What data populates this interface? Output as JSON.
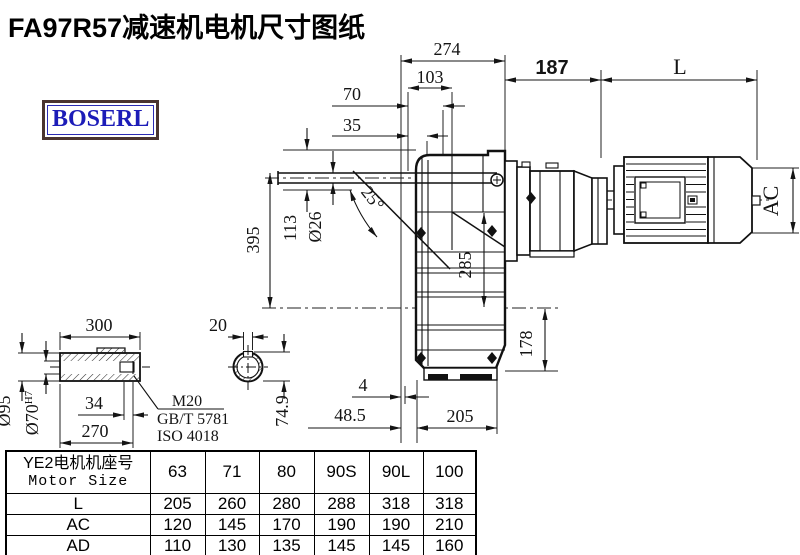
{
  "title": "FA97R57减速机电机尺寸图纸",
  "logo_text": "BOSERL",
  "dims": {
    "w274": "274",
    "w103": "103",
    "w70": "70",
    "w35": "35",
    "motor_gap": "187",
    "motor_len": "L",
    "motor_ac": "AC",
    "h395": "395",
    "h113": "113",
    "rod_dia": "Ø26",
    "angle": "25°",
    "h285": "285",
    "h178": "178",
    "off4": "4",
    "off485": "48.5",
    "w205": "205",
    "shaft_len": "300",
    "shaft_od": "Ø95",
    "bore": "Ø70",
    "bore_fit": "H7",
    "key34": "34",
    "w270": "270",
    "key20": "20",
    "h749": "74.9",
    "thread": "M20",
    "std_gb": "GB/T 5781",
    "std_iso": "ISO 4018"
  },
  "table": {
    "header_line1": "YE2电机机座号",
    "header_line2": "Motor Size",
    "sizes": [
      "63",
      "71",
      "80",
      "90S",
      "90L",
      "100"
    ],
    "rows": [
      {
        "label": "L",
        "values": [
          "205",
          "260",
          "280",
          "288",
          "318",
          "318"
        ]
      },
      {
        "label": "AC",
        "values": [
          "120",
          "145",
          "170",
          "190",
          "190",
          "210"
        ]
      },
      {
        "label": "AD",
        "values": [
          "110",
          "130",
          "135",
          "145",
          "145",
          "160"
        ]
      }
    ]
  }
}
